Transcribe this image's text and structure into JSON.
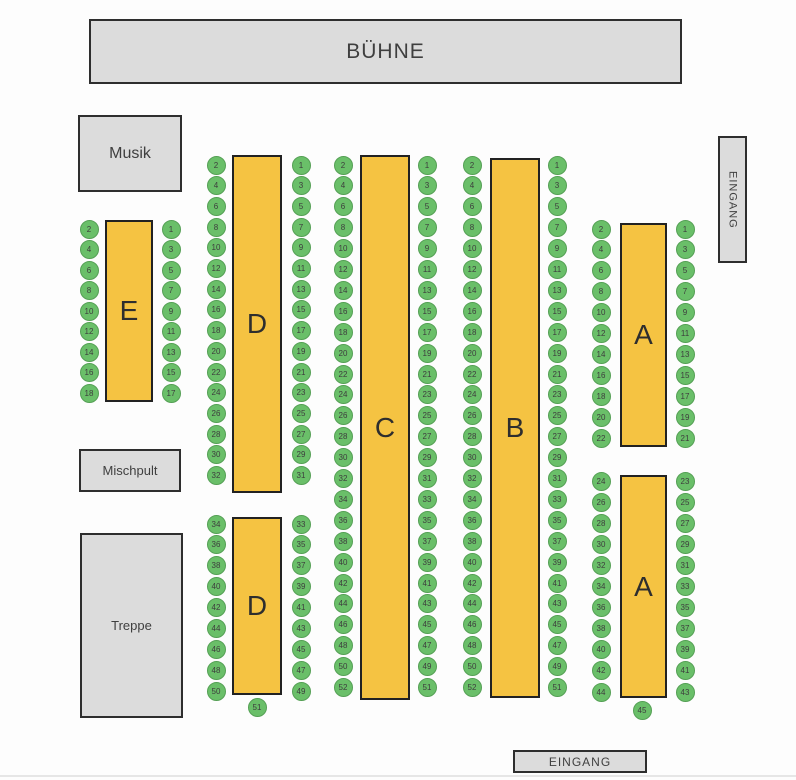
{
  "stage": {
    "label": "BÜHNE"
  },
  "rooms": {
    "musik": {
      "label": "Musik"
    },
    "mischpult": {
      "label": "Mischpult"
    },
    "treppe": {
      "label": "Treppe"
    }
  },
  "entrances": {
    "side": {
      "label": "EINGANG"
    },
    "bottom": {
      "label": "EINGANG"
    }
  },
  "colors": {
    "seat_fill": "#6abf69",
    "seat_border": "#55a055",
    "table_fill": "#f5c342",
    "table_border": "#222222",
    "room_fill": "#dcdcdc",
    "room_border": "#2e2e2e"
  },
  "tables": [
    {
      "id": "E",
      "label": "E",
      "rect": {
        "x": 105,
        "y": 220,
        "w": 48,
        "h": 182
      },
      "seats": {
        "left_x": 89,
        "right_x": 171,
        "start_y": 229,
        "dy": 20.5,
        "left": [
          2,
          4,
          6,
          8,
          10,
          12,
          14,
          16,
          18
        ],
        "right": [
          1,
          3,
          5,
          7,
          9,
          11,
          13,
          15,
          17
        ],
        "bottom": null
      }
    },
    {
      "id": "D1",
      "label": "D",
      "rect": {
        "x": 232,
        "y": 155,
        "w": 50,
        "h": 338
      },
      "seats": {
        "left_x": 216,
        "right_x": 301,
        "start_y": 165,
        "dy": 20.7,
        "left": [
          2,
          4,
          6,
          8,
          10,
          12,
          14,
          16,
          18,
          20,
          22,
          24,
          26,
          28,
          30,
          32
        ],
        "right": [
          1,
          3,
          5,
          7,
          9,
          11,
          13,
          15,
          17,
          19,
          21,
          23,
          25,
          27,
          29,
          31
        ],
        "bottom": null
      }
    },
    {
      "id": "D2",
      "label": "D",
      "rect": {
        "x": 232,
        "y": 517,
        "w": 50,
        "h": 178
      },
      "seats": {
        "left_x": 216,
        "right_x": 301,
        "start_y": 524,
        "dy": 20.9,
        "left": [
          34,
          36,
          38,
          40,
          42,
          44,
          46,
          48,
          50
        ],
        "right": [
          33,
          35,
          37,
          39,
          41,
          43,
          45,
          47,
          49
        ],
        "bottom": {
          "number": 51,
          "x": 257,
          "y": 707
        }
      }
    },
    {
      "id": "C",
      "label": "C",
      "rect": {
        "x": 360,
        "y": 155,
        "w": 50,
        "h": 545
      },
      "seats": {
        "left_x": 343,
        "right_x": 427,
        "start_y": 165,
        "dy": 20.9,
        "left": [
          2,
          4,
          6,
          8,
          10,
          12,
          14,
          16,
          18,
          20,
          22,
          24,
          26,
          28,
          30,
          32,
          34,
          36,
          38,
          40,
          42,
          44,
          46,
          48,
          50,
          52
        ],
        "right": [
          1,
          3,
          5,
          7,
          9,
          11,
          13,
          15,
          17,
          19,
          21,
          23,
          25,
          27,
          29,
          31,
          33,
          35,
          37,
          39,
          41,
          43,
          45,
          47,
          49,
          51
        ],
        "bottom": null
      }
    },
    {
      "id": "B",
      "label": "B",
      "rect": {
        "x": 490,
        "y": 158,
        "w": 50,
        "h": 540
      },
      "seats": {
        "left_x": 472,
        "right_x": 557,
        "start_y": 165,
        "dy": 20.9,
        "left": [
          2,
          4,
          6,
          8,
          10,
          12,
          14,
          16,
          18,
          20,
          22,
          24,
          26,
          28,
          30,
          32,
          34,
          36,
          38,
          40,
          42,
          44,
          46,
          48,
          50,
          52
        ],
        "right": [
          1,
          3,
          5,
          7,
          9,
          11,
          13,
          15,
          17,
          19,
          21,
          23,
          25,
          27,
          29,
          31,
          33,
          35,
          37,
          39,
          41,
          43,
          45,
          47,
          49,
          51
        ],
        "bottom": null
      }
    },
    {
      "id": "A1",
      "label": "A",
      "rect": {
        "x": 620,
        "y": 223,
        "w": 47,
        "h": 224
      },
      "seats": {
        "left_x": 601,
        "right_x": 685,
        "start_y": 229,
        "dy": 20.9,
        "left": [
          2,
          4,
          6,
          8,
          10,
          12,
          14,
          16,
          18,
          20,
          22
        ],
        "right": [
          1,
          3,
          5,
          7,
          9,
          11,
          13,
          15,
          17,
          19,
          21
        ],
        "bottom": null
      }
    },
    {
      "id": "A2",
      "label": "A",
      "rect": {
        "x": 620,
        "y": 475,
        "w": 47,
        "h": 223
      },
      "seats": {
        "left_x": 601,
        "right_x": 685,
        "start_y": 481,
        "dy": 21.1,
        "left": [
          24,
          26,
          28,
          30,
          32,
          34,
          36,
          38,
          40,
          42,
          44
        ],
        "right": [
          23,
          25,
          27,
          29,
          31,
          33,
          35,
          37,
          39,
          41,
          43
        ],
        "bottom": {
          "number": 45,
          "x": 642,
          "y": 710
        }
      }
    }
  ]
}
